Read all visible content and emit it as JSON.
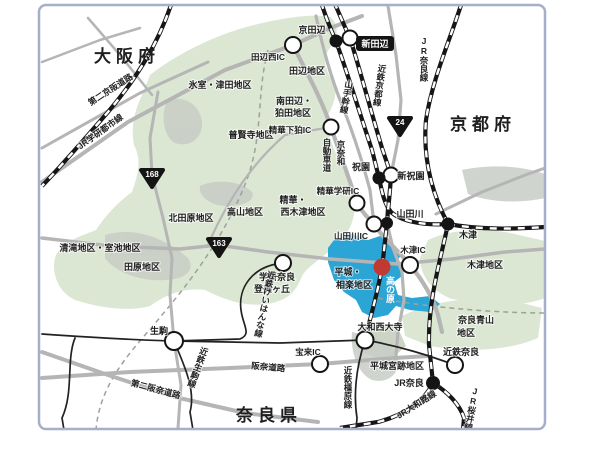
{
  "map": {
    "prefectures": {
      "osaka": "大阪府",
      "kyoto": "京都府",
      "nara": "奈良県"
    },
    "districts": {
      "himuro_tsuda": "氷室・津田地区",
      "tanabe": "田辺地区",
      "minami_tanabe": {
        "lines": [
          "南田辺・",
          "狛田地区"
        ]
      },
      "fugenji": "普賢寺地区",
      "kita_tawara": "北田原地区",
      "takayama": "高山地区",
      "seika_nishikizu": {
        "lines": [
          "精華・",
          "西木津地区"
        ]
      },
      "kiyotaki_muroike": "清滝地区・室池地区",
      "tawara": "田原地区",
      "kizu": "木津地区",
      "nara_aoyama": {
        "lines": [
          "奈良青山",
          "地区"
        ]
      },
      "heijo_sagara": {
        "lines": [
          "平城・",
          "相楽地区"
        ]
      },
      "heijokyuseki": "平城宮跡地区"
    },
    "stations": {
      "kyotanabe": "京田辺",
      "shintanabe": "新田辺",
      "hosono": "祝園",
      "shin_hosono": "新祝園",
      "yamadagawa": "山田川",
      "kizu": "木津",
      "takanohara": "高の原",
      "tomigaoka": {
        "lines": [
          "学研奈良",
          "登美ヶ丘"
        ]
      },
      "ikoma": "生駒",
      "yamato_saidaiji": "大和西大寺",
      "kintetsu_nara": "近鉄奈良",
      "jr_nara": "JR奈良"
    },
    "interchanges": {
      "tanabe_nishi": "田辺西IC",
      "seika_shimokoma": "精華下狛IC",
      "seika_gakken": "精華学研IC",
      "yamadagawa": "山田川IC",
      "kizu": "木津IC",
      "horai": "宝来IC"
    },
    "roads": {
      "daini_keihan": "第二京阪道路",
      "yamate_kansen": "山手幹線",
      "keinawa": {
        "lines": [
          "京奈和",
          "自動車道"
        ]
      },
      "hanna": "阪奈道路",
      "daini_hanna": "第二阪奈道路"
    },
    "railways": {
      "jr_gakkentoshi": "JR学研都市線",
      "kintetsu_kyoto": "近鉄京都線",
      "jr_nara_line": "JR奈良線",
      "kintetsu_keihanna": "近鉄けいはんな線",
      "kintetsu_ikoma": "近鉄生駒線",
      "kintetsu_kashihara": "近鉄橿原線",
      "jr_yamatoji": "JR大和路線",
      "jr_sakurai": "JR桜井線"
    },
    "route_badges": {
      "r168": "168",
      "r163": "163",
      "r24": "24"
    }
  },
  "colors": {
    "green": "#dbe7d2",
    "blue": "#2aa5d6",
    "red": "#c03a32",
    "road": "#b5b5b5",
    "rail": "#161616",
    "border": "#a6aec9"
  }
}
